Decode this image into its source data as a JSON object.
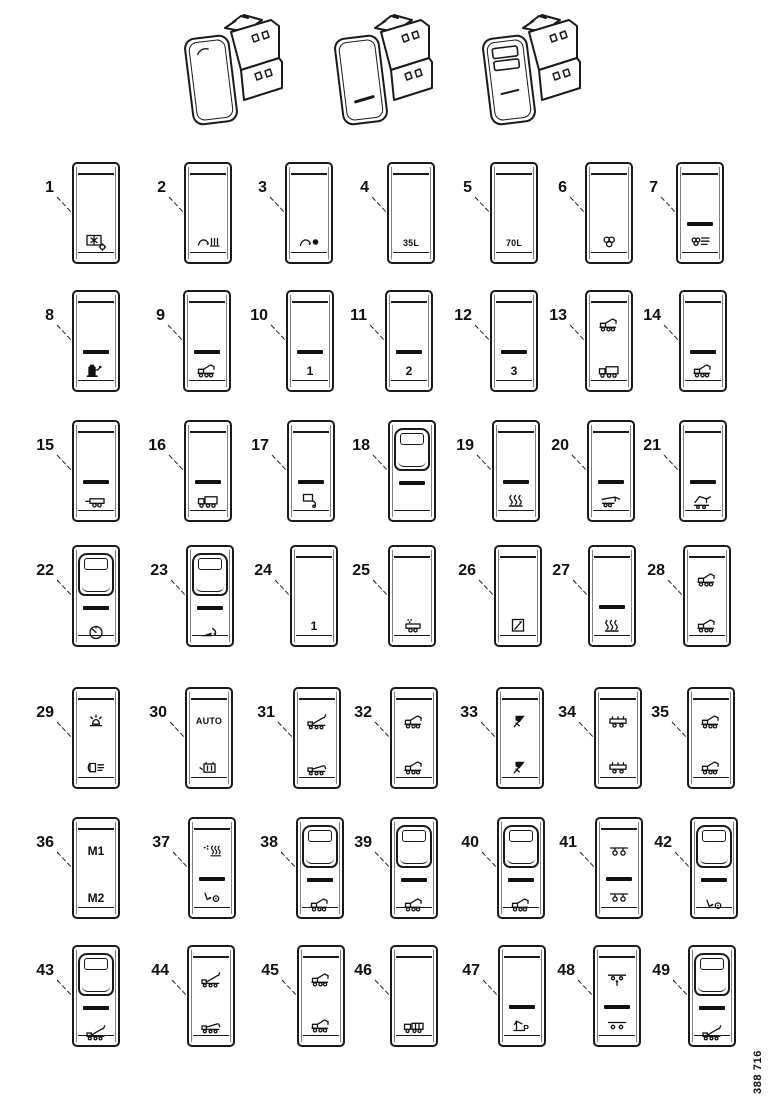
{
  "figure_number": "388 716",
  "assemblies": [
    {
      "name": "rocker-switch-module-plain",
      "variant": "plain"
    },
    {
      "name": "rocker-switch-module-dash",
      "variant": "dash"
    },
    {
      "name": "rocker-switch-module-window",
      "variant": "slots"
    }
  ],
  "switches": [
    {
      "number": "1",
      "style": "flat",
      "elements": [
        {
          "slot": "low",
          "type": "icon",
          "icon": "refrigeration-unit"
        }
      ]
    },
    {
      "number": "2",
      "style": "flat",
      "elements": [
        {
          "slot": "low",
          "type": "icon",
          "icon": "hook-sweep"
        }
      ]
    },
    {
      "number": "3",
      "style": "flat",
      "elements": [
        {
          "slot": "low",
          "type": "icon",
          "icon": "hook-grab"
        }
      ]
    },
    {
      "number": "4",
      "style": "flat",
      "elements": [
        {
          "slot": "low",
          "type": "text",
          "value": "35L"
        }
      ]
    },
    {
      "number": "5",
      "style": "flat",
      "elements": [
        {
          "slot": "low",
          "type": "text",
          "value": "70L"
        }
      ]
    },
    {
      "number": "6",
      "style": "flat",
      "elements": [
        {
          "slot": "low",
          "type": "icon",
          "icon": "fan"
        }
      ]
    },
    {
      "number": "7",
      "style": "flat",
      "elements": [
        {
          "slot": "mid",
          "type": "dash"
        },
        {
          "slot": "low",
          "type": "icon",
          "icon": "heater-fan"
        }
      ]
    },
    {
      "number": "8",
      "style": "flat",
      "elements": [
        {
          "slot": "mid",
          "type": "dash"
        },
        {
          "slot": "low",
          "type": "icon",
          "icon": "fuel-pump"
        }
      ]
    },
    {
      "number": "9",
      "style": "flat",
      "elements": [
        {
          "slot": "mid",
          "type": "dash"
        },
        {
          "slot": "low",
          "type": "icon",
          "icon": "crane-truck"
        }
      ]
    },
    {
      "number": "10",
      "style": "flat",
      "elements": [
        {
          "slot": "mid",
          "type": "dash"
        },
        {
          "slot": "low",
          "type": "text",
          "value": "1"
        }
      ]
    },
    {
      "number": "11",
      "style": "flat",
      "elements": [
        {
          "slot": "mid",
          "type": "dash"
        },
        {
          "slot": "low",
          "type": "text",
          "value": "2"
        }
      ]
    },
    {
      "number": "12",
      "style": "flat",
      "elements": [
        {
          "slot": "mid",
          "type": "dash"
        },
        {
          "slot": "low",
          "type": "text",
          "value": "3"
        }
      ]
    },
    {
      "number": "13",
      "style": "flat",
      "elements": [
        {
          "slot": "top",
          "type": "icon",
          "icon": "crane-truck"
        },
        {
          "slot": "low",
          "type": "icon",
          "icon": "truck"
        }
      ]
    },
    {
      "number": "14",
      "style": "flat",
      "elements": [
        {
          "slot": "mid",
          "type": "dash"
        },
        {
          "slot": "low",
          "type": "icon",
          "icon": "crane-truck"
        }
      ]
    },
    {
      "number": "15",
      "style": "flat",
      "elements": [
        {
          "slot": "mid",
          "type": "dash"
        },
        {
          "slot": "low",
          "type": "icon",
          "icon": "trailer"
        }
      ]
    },
    {
      "number": "16",
      "style": "flat",
      "elements": [
        {
          "slot": "mid",
          "type": "dash"
        },
        {
          "slot": "low",
          "type": "icon",
          "icon": "truck"
        }
      ]
    },
    {
      "number": "17",
      "style": "flat",
      "elements": [
        {
          "slot": "mid",
          "type": "dash"
        },
        {
          "slot": "low",
          "type": "icon",
          "icon": "coupling"
        }
      ]
    },
    {
      "number": "18",
      "style": "guard",
      "elements": [
        {
          "slot": "mid",
          "type": "dash"
        }
      ]
    },
    {
      "number": "19",
      "style": "flat",
      "elements": [
        {
          "slot": "mid",
          "type": "dash"
        },
        {
          "slot": "low",
          "type": "icon",
          "icon": "heated"
        }
      ]
    },
    {
      "number": "20",
      "style": "flat",
      "elements": [
        {
          "slot": "mid",
          "type": "dash"
        },
        {
          "slot": "low",
          "type": "icon",
          "icon": "crane-extend"
        }
      ]
    },
    {
      "number": "21",
      "style": "flat",
      "elements": [
        {
          "slot": "mid",
          "type": "dash"
        },
        {
          "slot": "low",
          "type": "icon",
          "icon": "crane-fold"
        }
      ]
    },
    {
      "number": "22",
      "style": "guard",
      "elements": [
        {
          "slot": "mid",
          "type": "dash"
        },
        {
          "slot": "low",
          "type": "icon",
          "icon": "gauge"
        }
      ]
    },
    {
      "number": "23",
      "style": "guard",
      "elements": [
        {
          "slot": "mid",
          "type": "dash"
        },
        {
          "slot": "low",
          "type": "icon",
          "icon": "tipping-hook"
        }
      ]
    },
    {
      "number": "24",
      "style": "flat",
      "elements": [
        {
          "slot": "low",
          "type": "text",
          "value": "1"
        }
      ]
    },
    {
      "number": "25",
      "style": "flat",
      "elements": [
        {
          "slot": "low",
          "type": "icon",
          "icon": "trailer-load"
        }
      ]
    },
    {
      "number": "26",
      "style": "flat",
      "elements": [
        {
          "slot": "low",
          "type": "icon",
          "icon": "cigarette-lighter"
        }
      ]
    },
    {
      "number": "27",
      "style": "flat",
      "elements": [
        {
          "slot": "mid",
          "type": "dash"
        },
        {
          "slot": "low",
          "type": "icon",
          "icon": "heated"
        }
      ]
    },
    {
      "number": "28",
      "style": "flat",
      "elements": [
        {
          "slot": "top",
          "type": "icon",
          "icon": "crane-truck"
        },
        {
          "slot": "low",
          "type": "icon",
          "icon": "crane-truck"
        }
      ]
    },
    {
      "number": "29",
      "style": "flat",
      "elements": [
        {
          "slot": "top",
          "type": "icon",
          "icon": "beacon"
        },
        {
          "slot": "low",
          "type": "icon",
          "icon": "work-light"
        }
      ]
    },
    {
      "number": "30",
      "style": "flat",
      "elements": [
        {
          "slot": "top",
          "type": "text",
          "value": "AUTO"
        },
        {
          "slot": "low",
          "type": "icon",
          "icon": "battery-box"
        }
      ]
    },
    {
      "number": "31",
      "style": "flat",
      "elements": [
        {
          "slot": "top",
          "type": "icon",
          "icon": "tipper-raise"
        },
        {
          "slot": "low",
          "type": "icon",
          "icon": "tipper-lower"
        }
      ]
    },
    {
      "number": "32",
      "style": "flat",
      "elements": [
        {
          "slot": "top",
          "type": "icon",
          "icon": "crane-truck"
        },
        {
          "slot": "low",
          "type": "icon",
          "icon": "crane-truck"
        }
      ]
    },
    {
      "number": "33",
      "style": "flat",
      "elements": [
        {
          "slot": "top",
          "type": "icon",
          "icon": "spreader-nozzle"
        },
        {
          "slot": "low",
          "type": "icon",
          "icon": "spreader-nozzle"
        }
      ]
    },
    {
      "number": "34",
      "style": "flat",
      "elements": [
        {
          "slot": "top",
          "type": "icon",
          "icon": "platform-trailer"
        },
        {
          "slot": "low",
          "type": "icon",
          "icon": "platform-trailer"
        }
      ]
    },
    {
      "number": "35",
      "style": "flat",
      "elements": [
        {
          "slot": "top",
          "type": "icon",
          "icon": "crane-truck"
        },
        {
          "slot": "low",
          "type": "icon",
          "icon": "crane-truck"
        }
      ]
    },
    {
      "number": "36",
      "style": "flat",
      "elements": [
        {
          "slot": "top",
          "type": "text",
          "value": "M1"
        },
        {
          "slot": "low",
          "type": "text",
          "value": "M2"
        }
      ]
    },
    {
      "number": "37",
      "style": "flat",
      "elements": [
        {
          "slot": "top",
          "type": "icon",
          "icon": "parking-heater"
        },
        {
          "slot": "mid",
          "type": "dash"
        },
        {
          "slot": "low",
          "type": "icon",
          "icon": "release-hook"
        }
      ]
    },
    {
      "number": "38",
      "style": "guard",
      "elements": [
        {
          "slot": "mid",
          "type": "dash"
        },
        {
          "slot": "low",
          "type": "icon",
          "icon": "crane-truck"
        }
      ]
    },
    {
      "number": "39",
      "style": "guard",
      "elements": [
        {
          "slot": "mid",
          "type": "dash"
        },
        {
          "slot": "low",
          "type": "icon",
          "icon": "crane-truck"
        }
      ]
    },
    {
      "number": "40",
      "style": "guard",
      "elements": [
        {
          "slot": "mid",
          "type": "dash"
        },
        {
          "slot": "low",
          "type": "icon",
          "icon": "crane-truck"
        }
      ]
    },
    {
      "number": "41",
      "style": "flat",
      "elements": [
        {
          "slot": "top",
          "type": "icon",
          "icon": "bogie-axle"
        },
        {
          "slot": "mid",
          "type": "dash"
        },
        {
          "slot": "low",
          "type": "icon",
          "icon": "bogie-axle"
        }
      ]
    },
    {
      "number": "42",
      "style": "guard",
      "elements": [
        {
          "slot": "mid",
          "type": "dash"
        },
        {
          "slot": "low",
          "type": "icon",
          "icon": "release-hook"
        }
      ]
    },
    {
      "number": "43",
      "style": "guard",
      "elements": [
        {
          "slot": "mid",
          "type": "dash"
        },
        {
          "slot": "low",
          "type": "icon",
          "icon": "tipper-raise"
        }
      ]
    },
    {
      "number": "44",
      "style": "flat",
      "elements": [
        {
          "slot": "top",
          "type": "icon",
          "icon": "tipper-raise"
        },
        {
          "slot": "low",
          "type": "icon",
          "icon": "tipper-lower"
        }
      ]
    },
    {
      "number": "45",
      "style": "flat",
      "elements": [
        {
          "slot": "top",
          "type": "icon",
          "icon": "crane-truck"
        },
        {
          "slot": "low",
          "type": "icon",
          "icon": "crane-truck"
        }
      ]
    },
    {
      "number": "46",
      "style": "flat",
      "elements": [
        {
          "slot": "low",
          "type": "icon",
          "icon": "truck-trailer"
        }
      ]
    },
    {
      "number": "47",
      "style": "flat",
      "elements": [
        {
          "slot": "mid",
          "type": "dash"
        },
        {
          "slot": "low",
          "type": "icon",
          "icon": "crane-park"
        }
      ]
    },
    {
      "number": "48",
      "style": "flat",
      "elements": [
        {
          "slot": "top",
          "type": "icon",
          "icon": "axle-lift"
        },
        {
          "slot": "mid",
          "type": "dash"
        },
        {
          "slot": "low",
          "type": "icon",
          "icon": "axle-lowered"
        }
      ]
    },
    {
      "number": "49",
      "style": "guard",
      "elements": [
        {
          "slot": "mid",
          "type": "dash"
        },
        {
          "slot": "low",
          "type": "icon",
          "icon": "tipper-raise"
        }
      ]
    }
  ]
}
